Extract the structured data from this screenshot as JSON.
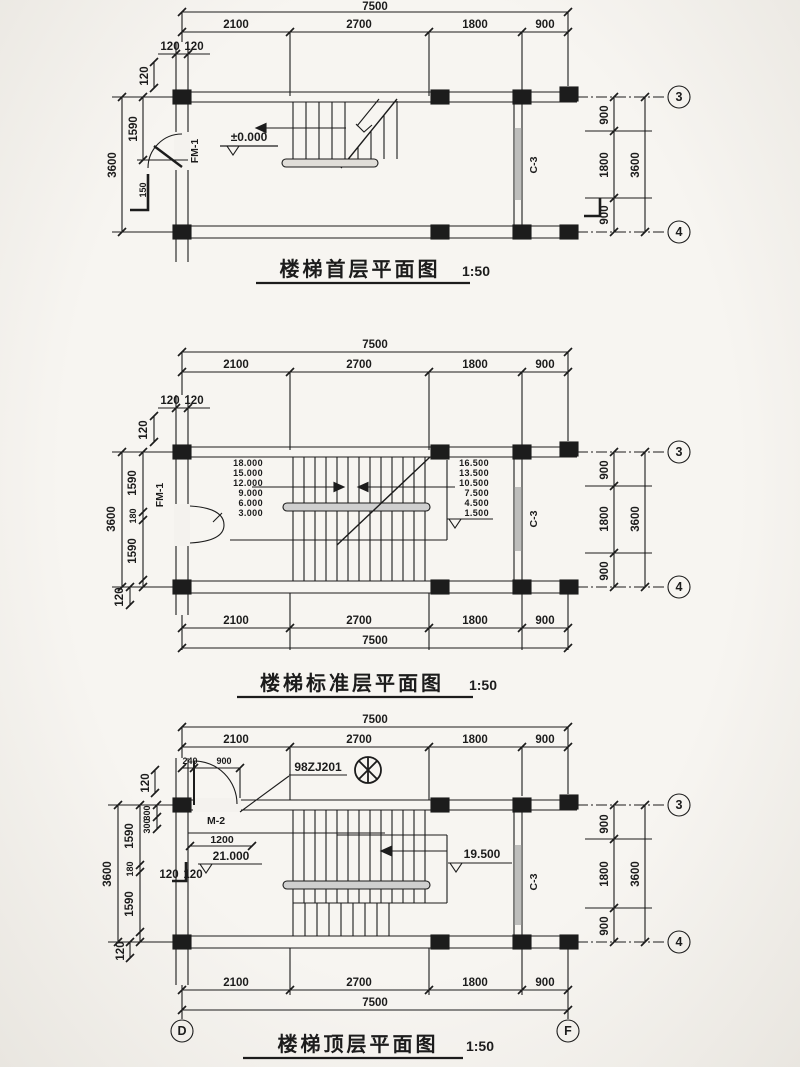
{
  "meta": {
    "bg": "#f4f2ee",
    "ink": "#1c1c1c",
    "window_gray": "#8f8f8f",
    "rail_gray": "#cfcfcf"
  },
  "d1": {
    "title": "楼梯首层平面图",
    "scale": "1:50",
    "total": "7500",
    "segs": [
      "2100",
      "2700",
      "1800",
      "900"
    ],
    "wall120": [
      "120",
      "120"
    ],
    "v120": "120",
    "v1590": "1590",
    "v3600": "3600",
    "v150": "150",
    "right": [
      "900",
      "1800",
      "900"
    ],
    "rtotal": "3600",
    "door": "FM-1",
    "elev": "±0.000",
    "win": "C-3",
    "b3": "3",
    "b4": "4"
  },
  "d2": {
    "title": "楼梯标准层平面图",
    "scale": "1:50",
    "total": "7500",
    "segs": [
      "2100",
      "2700",
      "1800",
      "900"
    ],
    "bsegs": [
      "2100",
      "2700",
      "1800",
      "900"
    ],
    "btotal": "7500",
    "wall120": [
      "120",
      "120"
    ],
    "v120": "120",
    "left": [
      "1590",
      "180",
      "1590"
    ],
    "v3600": "3600",
    "v120b": "120",
    "right": [
      "900",
      "1800",
      "900"
    ],
    "rtotal": "3600",
    "lev": [
      "18.000",
      "15.000",
      "12.000",
      "9.000",
      "6.000",
      "3.000"
    ],
    "rlev": [
      "16.500",
      "13.500",
      "10.500",
      "7.500",
      "4.500",
      "1.500"
    ],
    "door": "FM-1",
    "win": "C-3",
    "b3": "3",
    "b4": "4"
  },
  "d3": {
    "title": "楼梯顶层平面图",
    "scale": "1:50",
    "total": "7500",
    "segs": [
      "2100",
      "2700",
      "1800",
      "900"
    ],
    "bsegs": [
      "2100",
      "2700",
      "1800",
      "900"
    ],
    "btotal": "7500",
    "d240": "240",
    "d900": "900",
    "door": "M-2",
    "ref": "98ZJ201",
    "d1200": "1200",
    "v120top": "120",
    "c300": [
      "300",
      "300"
    ],
    "w120": [
      "120",
      "120"
    ],
    "left": [
      "1590",
      "180",
      "1590"
    ],
    "v3600": "3600",
    "v120b": "120",
    "elev1": "21.000",
    "elev2": "19.500",
    "win": "C-3",
    "right": [
      "900",
      "1800",
      "900"
    ],
    "rtotal": "3600",
    "b3": "3",
    "b4": "4",
    "bD": "D",
    "bF": "F"
  }
}
